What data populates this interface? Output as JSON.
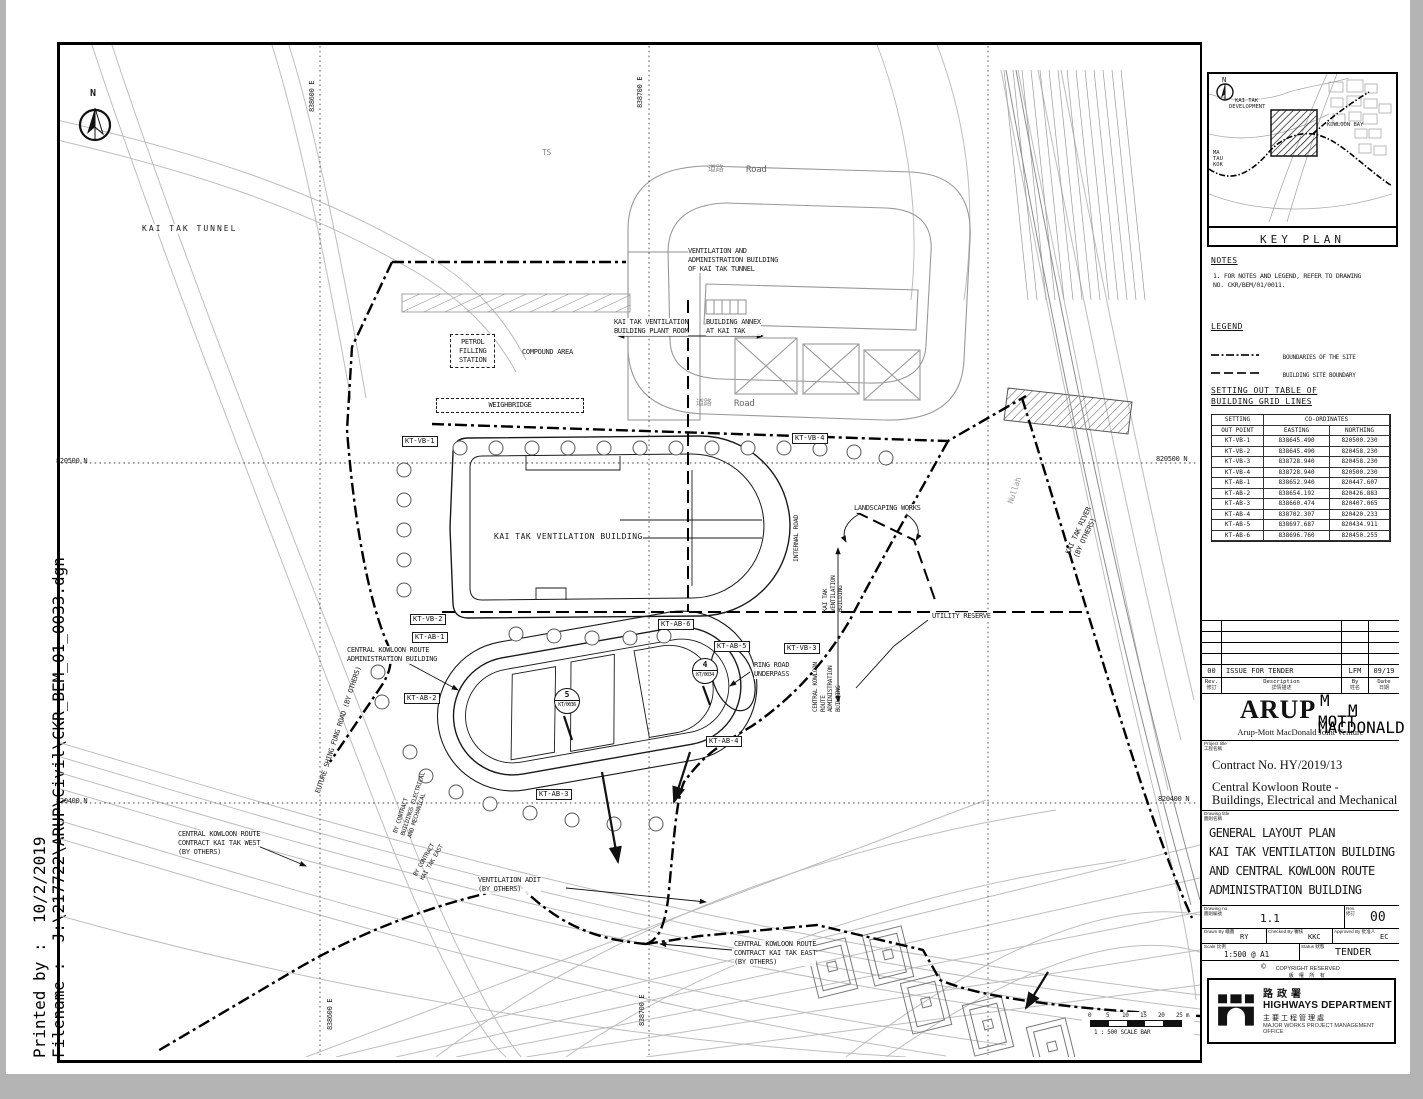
{
  "sheet": {
    "printed_by_label": "Printed by :",
    "printed_by_value": "10/2/2019",
    "filename_label": "Filename :",
    "filename_value": "J:\\217722\\ARUP\\Civil\\CKR_BEM_01_0033.dgn"
  },
  "plan": {
    "north": "N",
    "grid": {
      "n_820500": "820500 N",
      "n_820400": "820400 N",
      "e_838600": "838600 E",
      "e_838700": "838700 E"
    },
    "labels": {
      "kai_tak_tunnel": "KAI TAK TUNNEL",
      "ts": "TS",
      "road_zh": "道路",
      "road_en": "Road",
      "vent_admin_building": "VENTILATION AND\nADMINISTRATION BUILDING\nOF KAI TAK TUNNEL",
      "plant_room": "KAI TAK VENTILATION\nBUILDING PLANT ROOM",
      "building_annex": "BUILDING ANNEX\nAT KAI TAK",
      "petrol_station": "PETROL\nFILLING\nSTATION",
      "compound_area": "COMPOUND AREA",
      "weighbridge": "WEIGHBRIDGE",
      "kt_vent_building": "KAI TAK VENTILATION BUILDING",
      "internal_road": "INTERNAL ROAD",
      "landscaping": "LANDSCAPING WORKS",
      "nullah": "Nullah",
      "kai_tak_river": "KAI TAK RIVER\n(BY OTHERS)",
      "utility_reserve": "UTILITY RESERVE",
      "kt_vb_vertical": "KAI TAK\nVENTILATION\nBUILDING",
      "ckr_ab_vertical": "CENTRAL KOWLOON\nROUTE\nADMINISTRATION\nBUILDING",
      "ckr_admin_building": "CENTRAL KOWLOON ROUTE\nADMINISTRATION BUILDING",
      "ring_road_underpass": "RING ROAD\nUNDERPASS",
      "future_shing_fung": "FUTURE SHING FUNG ROAD (BY OTHERS)",
      "by_contract_bem": "BY CONTRACT\nBUILDINGS ELECTRICAL\nAND MECHANICAL",
      "by_contract_kte": "BY CONTRACT\nKAI TAK EAST",
      "ckr_west": "CENTRAL KOWLOON ROUTE\nCONTRACT KAI TAK WEST\n(BY OTHERS)",
      "ventilation_adit": "VENTILATION ADIT\n(BY OTHERS)",
      "ckr_east": "CENTRAL KOWLOON ROUTE\nCONTRACT KAI TAK EAST\n(BY OTHERS)"
    },
    "markers": {
      "vb1": "KT-VB-1",
      "vb2": "KT-VB-2",
      "vb3": "KT-VB-3",
      "vb4": "KT-VB-4",
      "ab1": "KT-AB-1",
      "ab2": "KT-AB-2",
      "ab3": "KT-AB-3",
      "ab4": "KT-AB-4",
      "ab5": "KT-AB-5",
      "ab6": "KT-AB-6"
    },
    "sections": {
      "s5_num": "5",
      "s5_ref": "KT/0036",
      "s4_num": "4",
      "s4_ref": "KT/0034"
    },
    "scale_bar": {
      "t0": "0",
      "t1": "5",
      "t2": "10",
      "t3": "15",
      "t4": "20",
      "t5": "25 m",
      "caption": "1 : 500  SCALE BAR"
    }
  },
  "key_plan": {
    "title": "KEY PLAN",
    "north": "N",
    "dev1": "KAI TAK",
    "dev2": "DEVELOPMENT",
    "bay": "KOWLOON BAY",
    "ma1": "MA",
    "ma2": "TAU",
    "ma3": "KOK"
  },
  "notes": {
    "heading": "NOTES",
    "item1": "1. FOR NOTES AND LEGEND, REFER TO DRAWING\n    NO. CKR/BEM/01/0011."
  },
  "legend": {
    "heading": "LEGEND",
    "site_boundary": "BOUNDARIES OF THE SITE",
    "building_boundary": "BUILDING SITE BOUNDARY"
  },
  "setting_out": {
    "heading": "SETTING OUT TABLE OF\nBUILDING GRID LINES",
    "col_point1": "SETTING",
    "col_point2": "OUT POINT",
    "col_coords": "CO-ORDINATES",
    "col_easting": "EASTING",
    "col_northing": "NORTHING",
    "rows": [
      [
        "KT-VB-1",
        "838645.490",
        "820500.230"
      ],
      [
        "KT-VB-2",
        "838645.490",
        "820458.230"
      ],
      [
        "KT-VB-3",
        "838728.940",
        "820458.230"
      ],
      [
        "KT-VB-4",
        "838728.940",
        "820500.230"
      ],
      [
        "KT-AB-1",
        "838652.940",
        "820447.607"
      ],
      [
        "KT-AB-2",
        "838654.192",
        "820426.883"
      ],
      [
        "KT-AB-3",
        "838660.474",
        "820407.065"
      ],
      [
        "KT-AB-4",
        "838702.307",
        "820420.233"
      ],
      [
        "KT-AB-5",
        "838697.687",
        "820434.911"
      ],
      [
        "KT-AB-6",
        "838696.760",
        "820450.255"
      ]
    ]
  },
  "revision": {
    "rev": "00",
    "description": "ISSUE FOR TENDER",
    "by": "LFM",
    "date": "09/19",
    "h_rev": "Rev.",
    "h_rev_zh": "修訂",
    "h_desc": "Description",
    "h_desc_zh": "詳情描述",
    "h_by": "By",
    "h_by_zh": "姓名",
    "h_date": "Date",
    "h_date_zh": "日期"
  },
  "consultant": {
    "arup": "ARUP",
    "m1": "M",
    "m2": "M",
    "mott": "MOTT",
    "macdonald": "MACDONALD",
    "jv": "Arup-Mott MacDonald Joint Venture"
  },
  "project": {
    "label": "Project title",
    "label_zh": "工程名稱",
    "contract": "Contract No. HY/2019/13",
    "name1": "Central Kowloon Route -",
    "name2": "Buildings, Electrical and Mechanical"
  },
  "drawing": {
    "label": "Drawing title",
    "label_zh": "圖則名稱",
    "t1": "GENERAL LAYOUT PLAN",
    "t2": "KAI TAK VENTILATION BUILDING",
    "t3": "AND CENTRAL KOWLOON ROUTE",
    "t4": "ADMINISTRATION BUILDING",
    "no_label": "Drawing no.",
    "no_label_zh": "圖則編號",
    "no": "1.1",
    "rev_label": "Rev.",
    "rev_label_zh": "修訂",
    "rev": "00",
    "drawn_label": "Drawn By",
    "drawn_zh": "繪圖",
    "drawn": "RY",
    "checked_label": "Checked By",
    "checked_zh": "審核",
    "checked": "KKC",
    "approved_label": "Approved By",
    "approved_zh": "批准人",
    "approved": "EC",
    "scale_label": "Scale",
    "scale_zh": "比例",
    "scale": "1:500 @ A1",
    "status_label": "Status",
    "status_zh": "狀態",
    "status": "TENDER",
    "copyright1": "COPYRIGHT RESERVED",
    "copyright2": "版 權 所 有"
  },
  "department": {
    "zh": "路政署",
    "en": "HIGHWAYS DEPARTMENT",
    "office_zh": "主要工程管理處",
    "office_en": "MAJOR WORKS PROJECT MANAGEMENT OFFICE"
  }
}
